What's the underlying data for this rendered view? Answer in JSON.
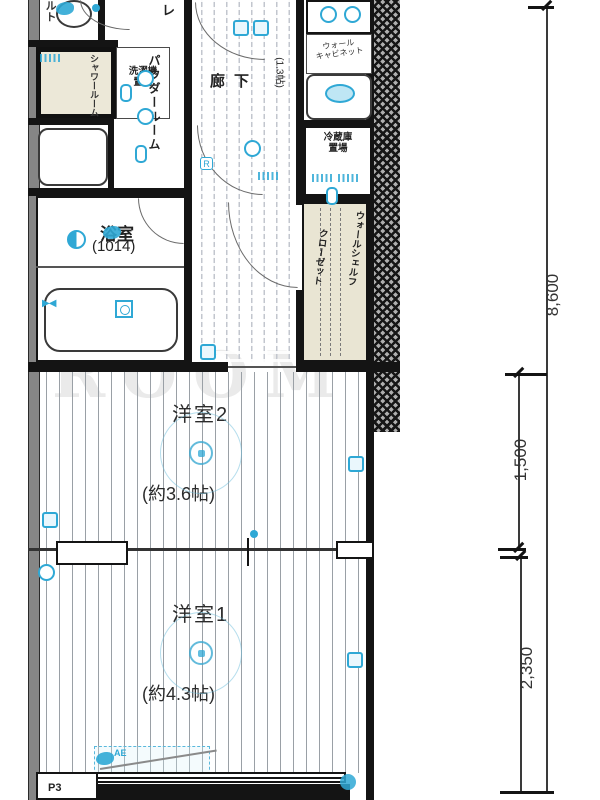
{
  "watermark": "ROOM",
  "rooms": {
    "bath": {
      "name": "浴室",
      "size": "(1014)"
    },
    "west2": {
      "name": "洋室2",
      "size": "(約3.6帖)"
    },
    "west1": {
      "name": "洋室1",
      "size": "(約4.3帖)"
    },
    "corridor": {
      "name": "廊下",
      "size": "(1.3帖)"
    },
    "powder": {
      "name": "パウダールーム"
    },
    "shower": {
      "name": "シャワールーム"
    },
    "washing": {
      "line1": "洗濯機",
      "line2": "置場"
    },
    "fridge": {
      "line1": "冷蔵庫",
      "line2": "置場"
    },
    "closet": {
      "line1": "ウォールシェルフ",
      "line2": "クローゼット"
    },
    "kitchen": {
      "line1": "ウォール",
      "line2": "キャビネット"
    }
  },
  "labels": {
    "r": "R",
    "ac": "AE",
    "p3": "P3",
    "toilet_fragment": "レ",
    "left_fragment": "ルト"
  },
  "dims": {
    "total": "8,600",
    "upper": "1,500",
    "lower": "2,350"
  },
  "colors": {
    "accent": "#2fa8d5",
    "wall": "#141414",
    "beige": "#e9e5d3",
    "floor_line": "#9aa0a6"
  },
  "icon_kinds": [
    "outlet-dot",
    "light-ring",
    "half-light",
    "switch-square",
    "outlet-tag",
    "wall-pill",
    "water-blob",
    "sink-oval",
    "faucet",
    "ceiling-light"
  ],
  "markers": [
    {
      "x": 56,
      "y": 2,
      "k": "blob"
    },
    {
      "x": 92,
      "y": 4,
      "k": "dot"
    },
    {
      "x": 40,
      "y": 54,
      "k": "tag"
    },
    {
      "x": 137,
      "y": 70,
      "k": "ring"
    },
    {
      "x": 120,
      "y": 84,
      "k": "pill"
    },
    {
      "x": 137,
      "y": 108,
      "k": "ring"
    },
    {
      "x": 135,
      "y": 145,
      "k": "pill"
    },
    {
      "x": 233,
      "y": 20,
      "k": "sq"
    },
    {
      "x": 253,
      "y": 20,
      "k": "sq"
    },
    {
      "x": 244,
      "y": 140,
      "k": "ring"
    },
    {
      "x": 258,
      "y": 172,
      "k": "tag"
    },
    {
      "x": 103,
      "y": 226,
      "k": "blob"
    },
    {
      "x": 67,
      "y": 230,
      "k": "half"
    },
    {
      "x": 42,
      "y": 293,
      "k": "faucet"
    },
    {
      "x": 115,
      "y": 300,
      "k": "sqd"
    },
    {
      "x": 320,
      "y": 6,
      "k": "ring"
    },
    {
      "x": 344,
      "y": 6,
      "k": "ring"
    },
    {
      "x": 325,
      "y": 84,
      "k": "oval"
    },
    {
      "x": 312,
      "y": 174,
      "k": "tag"
    },
    {
      "x": 338,
      "y": 174,
      "k": "tag"
    },
    {
      "x": 326,
      "y": 187,
      "k": "pill"
    },
    {
      "x": 200,
      "y": 344,
      "k": "sq"
    },
    {
      "x": 160,
      "y": 412,
      "k": "light"
    },
    {
      "x": 348,
      "y": 456,
      "k": "sq"
    },
    {
      "x": 42,
      "y": 512,
      "k": "sq"
    },
    {
      "x": 250,
      "y": 530,
      "k": "dot"
    },
    {
      "x": 160,
      "y": 612,
      "k": "light"
    },
    {
      "x": 347,
      "y": 652,
      "k": "sq"
    },
    {
      "x": 38,
      "y": 564,
      "k": "ring"
    },
    {
      "x": 340,
      "y": 774,
      "k": "dot-lg"
    },
    {
      "x": 96,
      "y": 752,
      "k": "blob"
    }
  ]
}
